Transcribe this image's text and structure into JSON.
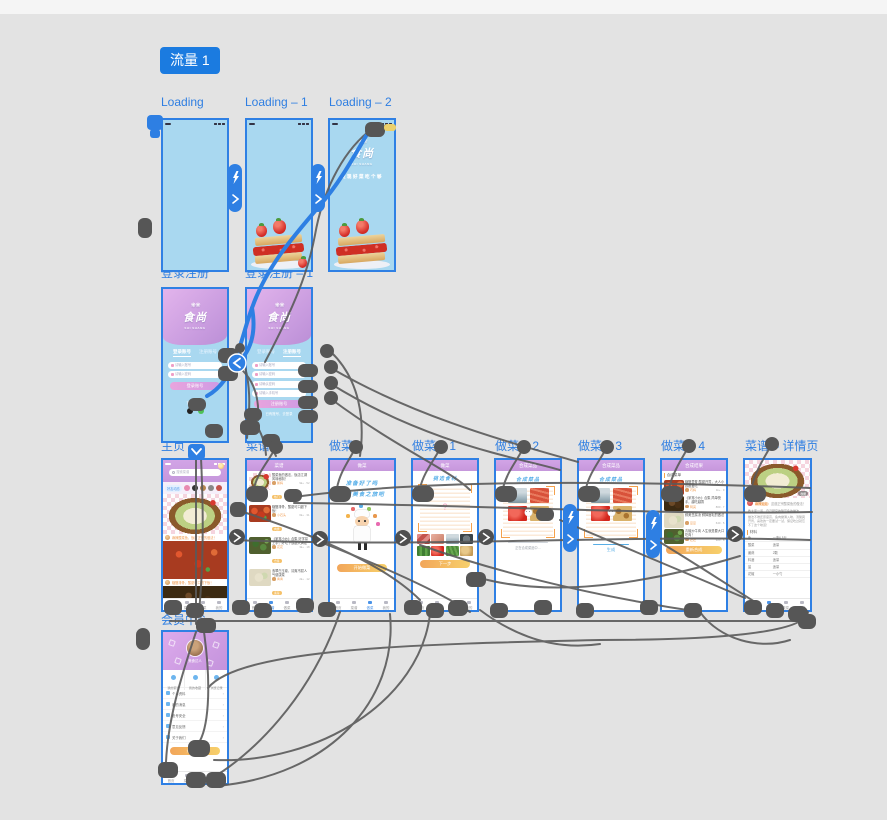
{
  "flow_badge": "流量 1",
  "screen_labels": {
    "loading": "Loading",
    "loading1": "Loading – 1",
    "loading2": "Loading – 2",
    "login": "登录注册",
    "login1": "登录注册 – 1",
    "home": "主页",
    "recipe": "菜谱",
    "cook": "做菜",
    "cook1": "做菜 – 1",
    "cook2": "做菜 – 2",
    "cook3": "做菜 – 3",
    "cook4": "做菜 – 4",
    "detail": "菜谱 – 详情页",
    "member": "会员中心"
  },
  "brand": {
    "logo": "食尚",
    "logo_sub": "SHI SHANG",
    "tagline": "发现好菜吃个够"
  },
  "login": {
    "tab_login": "登录账号",
    "tab_register": "注册账号",
    "account_placeholder": "请输入账号",
    "password_placeholder": "请输入密码",
    "confirm_placeholder": "请确认密码",
    "phone_placeholder": "请输入手机号",
    "login_button": "登录账号",
    "register_button": "注册账号",
    "third_party": "第三方登录",
    "to_login_hint": "已有账号，去登录"
  },
  "home": {
    "search_placeholder": "搜索菜谱",
    "story_chip": "好友动态",
    "card1_caption": "麻辣酸菜鱼，饭店正宗的做法！",
    "card2_caption": "糖醋排骨，酸甜可口超下饭！"
  },
  "recipe_list": {
    "header": "菜谱",
    "items": [
      {
        "t": "酸菜鱼的做法，饭店江湖风味秘制！",
        "a": "鹅妈",
        "m": "9k+ · 52",
        "tag": "热门"
      },
      {
        "t": "糖醋排骨，酸甜可口超下饭！",
        "a": "小石头",
        "m": "6k+ · 31",
        "tag": "肉类"
      },
      {
        "t": "《家常小炒》合集 好学易上手，好吃下饭超大满足",
        "a": "花花",
        "m": "3k+ · 18",
        "tag": "合集"
      },
      {
        "t": "翡翠白玉卷，清爽不腻人气健康菜",
        "a": "青青",
        "m": "2k+ · 12",
        "tag": "素菜"
      },
      {
        "t": "爆炒牛肉合集，人生就是要大口吃肉！",
        "a": "壮壮",
        "m": "5k+ · 26",
        "tag": "牛肉"
      }
    ]
  },
  "cook": {
    "header": "做菜",
    "line1": "准备好了吗",
    "line2": "开启美食之旅吧",
    "start_button": "开始做菜"
  },
  "cook1": {
    "header": "做菜",
    "title": "挑选食材",
    "qmark": "?",
    "next_button": "下一步"
  },
  "cook2": {
    "header": "合成菜品",
    "title": "合成菜品",
    "progress_text": "正在合成菜品中…"
  },
  "cook3": {
    "header": "合成菜品",
    "title": "合成菜品",
    "generate_link": "生成"
  },
  "cook4": {
    "header": "合成结果",
    "section": "合成菜单",
    "redo_button": "重新合成",
    "items": [
      {
        "t": "糖醋里脊 酸甜开胃，大人小孩都爱吃",
        "a": "巧妈",
        "m": "1k+ · 9"
      },
      {
        "t": "《家常小炒》合集 简单快手，越吃越香",
        "a": "阿亮",
        "m": "860 · 7"
      },
      {
        "t": "鲜美豆腐汤 鲜掉眉毛的做法",
        "a": "豆豆",
        "m": "640 · 5"
      },
      {
        "t": "青椒炒牛肉 人生就是要大口吃肉！",
        "a": "壮壮",
        "m": "920 · 8"
      }
    ]
  },
  "detail": {
    "collect_badge": "收藏",
    "author": "麻辣姐姐：",
    "author_line": "这道正宗酸菜鱼的做法！",
    "para1": "教大家一道，自己研究的酸菜鱼的做法",
    "para2": "做法不难还原度高，鱼肉嫩滑入味，汤酸爽开胃，喜欢的一定要试一试，保证吃过就忘不了这个味道！",
    "section": "材料",
    "ingredients": [
      [
        "鱼",
        "一条6.5斤"
      ],
      [
        "酸菜",
        "适量"
      ],
      [
        "姜蒜",
        "2颗"
      ],
      [
        "料酒",
        "适量"
      ],
      [
        "盐",
        "适量"
      ],
      [
        "花椒",
        "一小勺"
      ],
      [
        "辣椒粉",
        "适量"
      ]
    ]
  },
  "member": {
    "name": "美食达人",
    "stats": [
      "我的菜谱",
      "我的收藏",
      "浏览记录"
    ],
    "menu": [
      "个人资料",
      "我的消息",
      "账号安全",
      "意见反馈",
      "关于我们"
    ],
    "logout_button": "退出登录"
  },
  "tabbar": [
    "首页",
    "菜谱",
    "做菜",
    "我的"
  ],
  "colors": {
    "accent_blue": "#2e7ee2",
    "screen_blue": "#a9d8f0",
    "header_purple": "#cf9fe2",
    "connector_gray": "#575757",
    "button_orange": "#f2a65a"
  }
}
